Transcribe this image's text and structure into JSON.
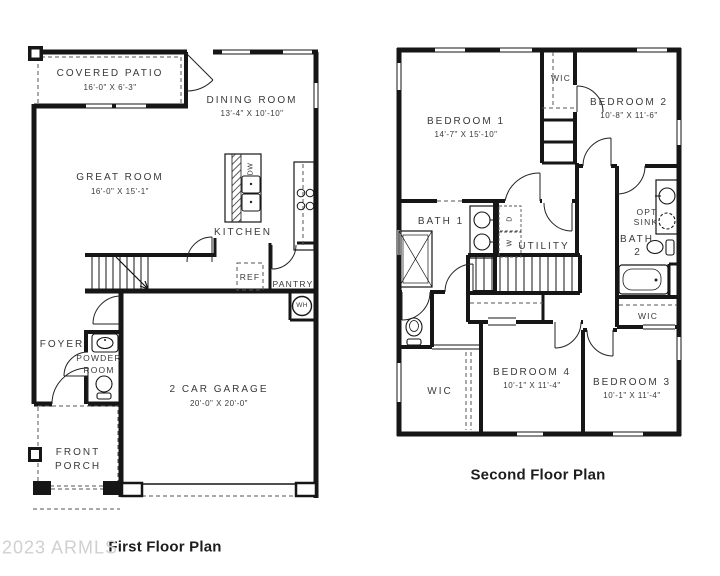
{
  "watermark": "2023 ARMLS",
  "colors": {
    "background": "#ffffff",
    "wall": "#161616",
    "label": "#3a3a3a",
    "title": "#1d1d1d",
    "watermark": "#d0d0d0"
  },
  "first_floor": {
    "title": "First Floor Plan",
    "rooms": {
      "covered_patio": {
        "name": "COVERED PATIO",
        "dims": "16'-0\" X 6'-3\""
      },
      "dining_room": {
        "name": "DINING ROOM",
        "dims": "13'-4\" X 10'-10\""
      },
      "great_room": {
        "name": "GREAT ROOM",
        "dims": "16'-0\" X 15'-1\""
      },
      "kitchen": {
        "name": "KITCHEN"
      },
      "ref": {
        "name": "REF"
      },
      "pantry": {
        "name": "PANTRY"
      },
      "wh": {
        "name": "WH"
      },
      "dw": {
        "name": "DW"
      },
      "foyer": {
        "name": "FOYER"
      },
      "powder_room": {
        "line1": "POWDER",
        "line2": "ROOM"
      },
      "garage": {
        "name": "2 CAR GARAGE",
        "dims": "20'-0\" X 20'-0\""
      },
      "front_porch": {
        "line1": "FRONT",
        "line2": "PORCH"
      }
    }
  },
  "second_floor": {
    "title": "Second Floor Plan",
    "rooms": {
      "bedroom1": {
        "name": "BEDROOM 1",
        "dims": "14'-7\" X 15'-10\""
      },
      "bedroom2": {
        "name": "BEDROOM 2",
        "dims": "10'-8\" X 11'-6\""
      },
      "bedroom3": {
        "name": "BEDROOM 3",
        "dims": "10'-1\" X 11'-4\""
      },
      "bedroom4": {
        "name": "BEDROOM 4",
        "dims": "10'-1\" X 11'-4\""
      },
      "bath1": {
        "name": "BATH 1"
      },
      "bath2": {
        "line1": "BATH",
        "line2": "2"
      },
      "opt_sink": {
        "line1": "OPT",
        "line2": "SINK"
      },
      "utility": {
        "name": "UTILITY"
      },
      "wic_top": {
        "name": "WIC"
      },
      "wic_right": {
        "name": "WIC"
      },
      "wic_left": {
        "name": "WIC"
      },
      "washer": "W",
      "dryer": "D"
    }
  }
}
